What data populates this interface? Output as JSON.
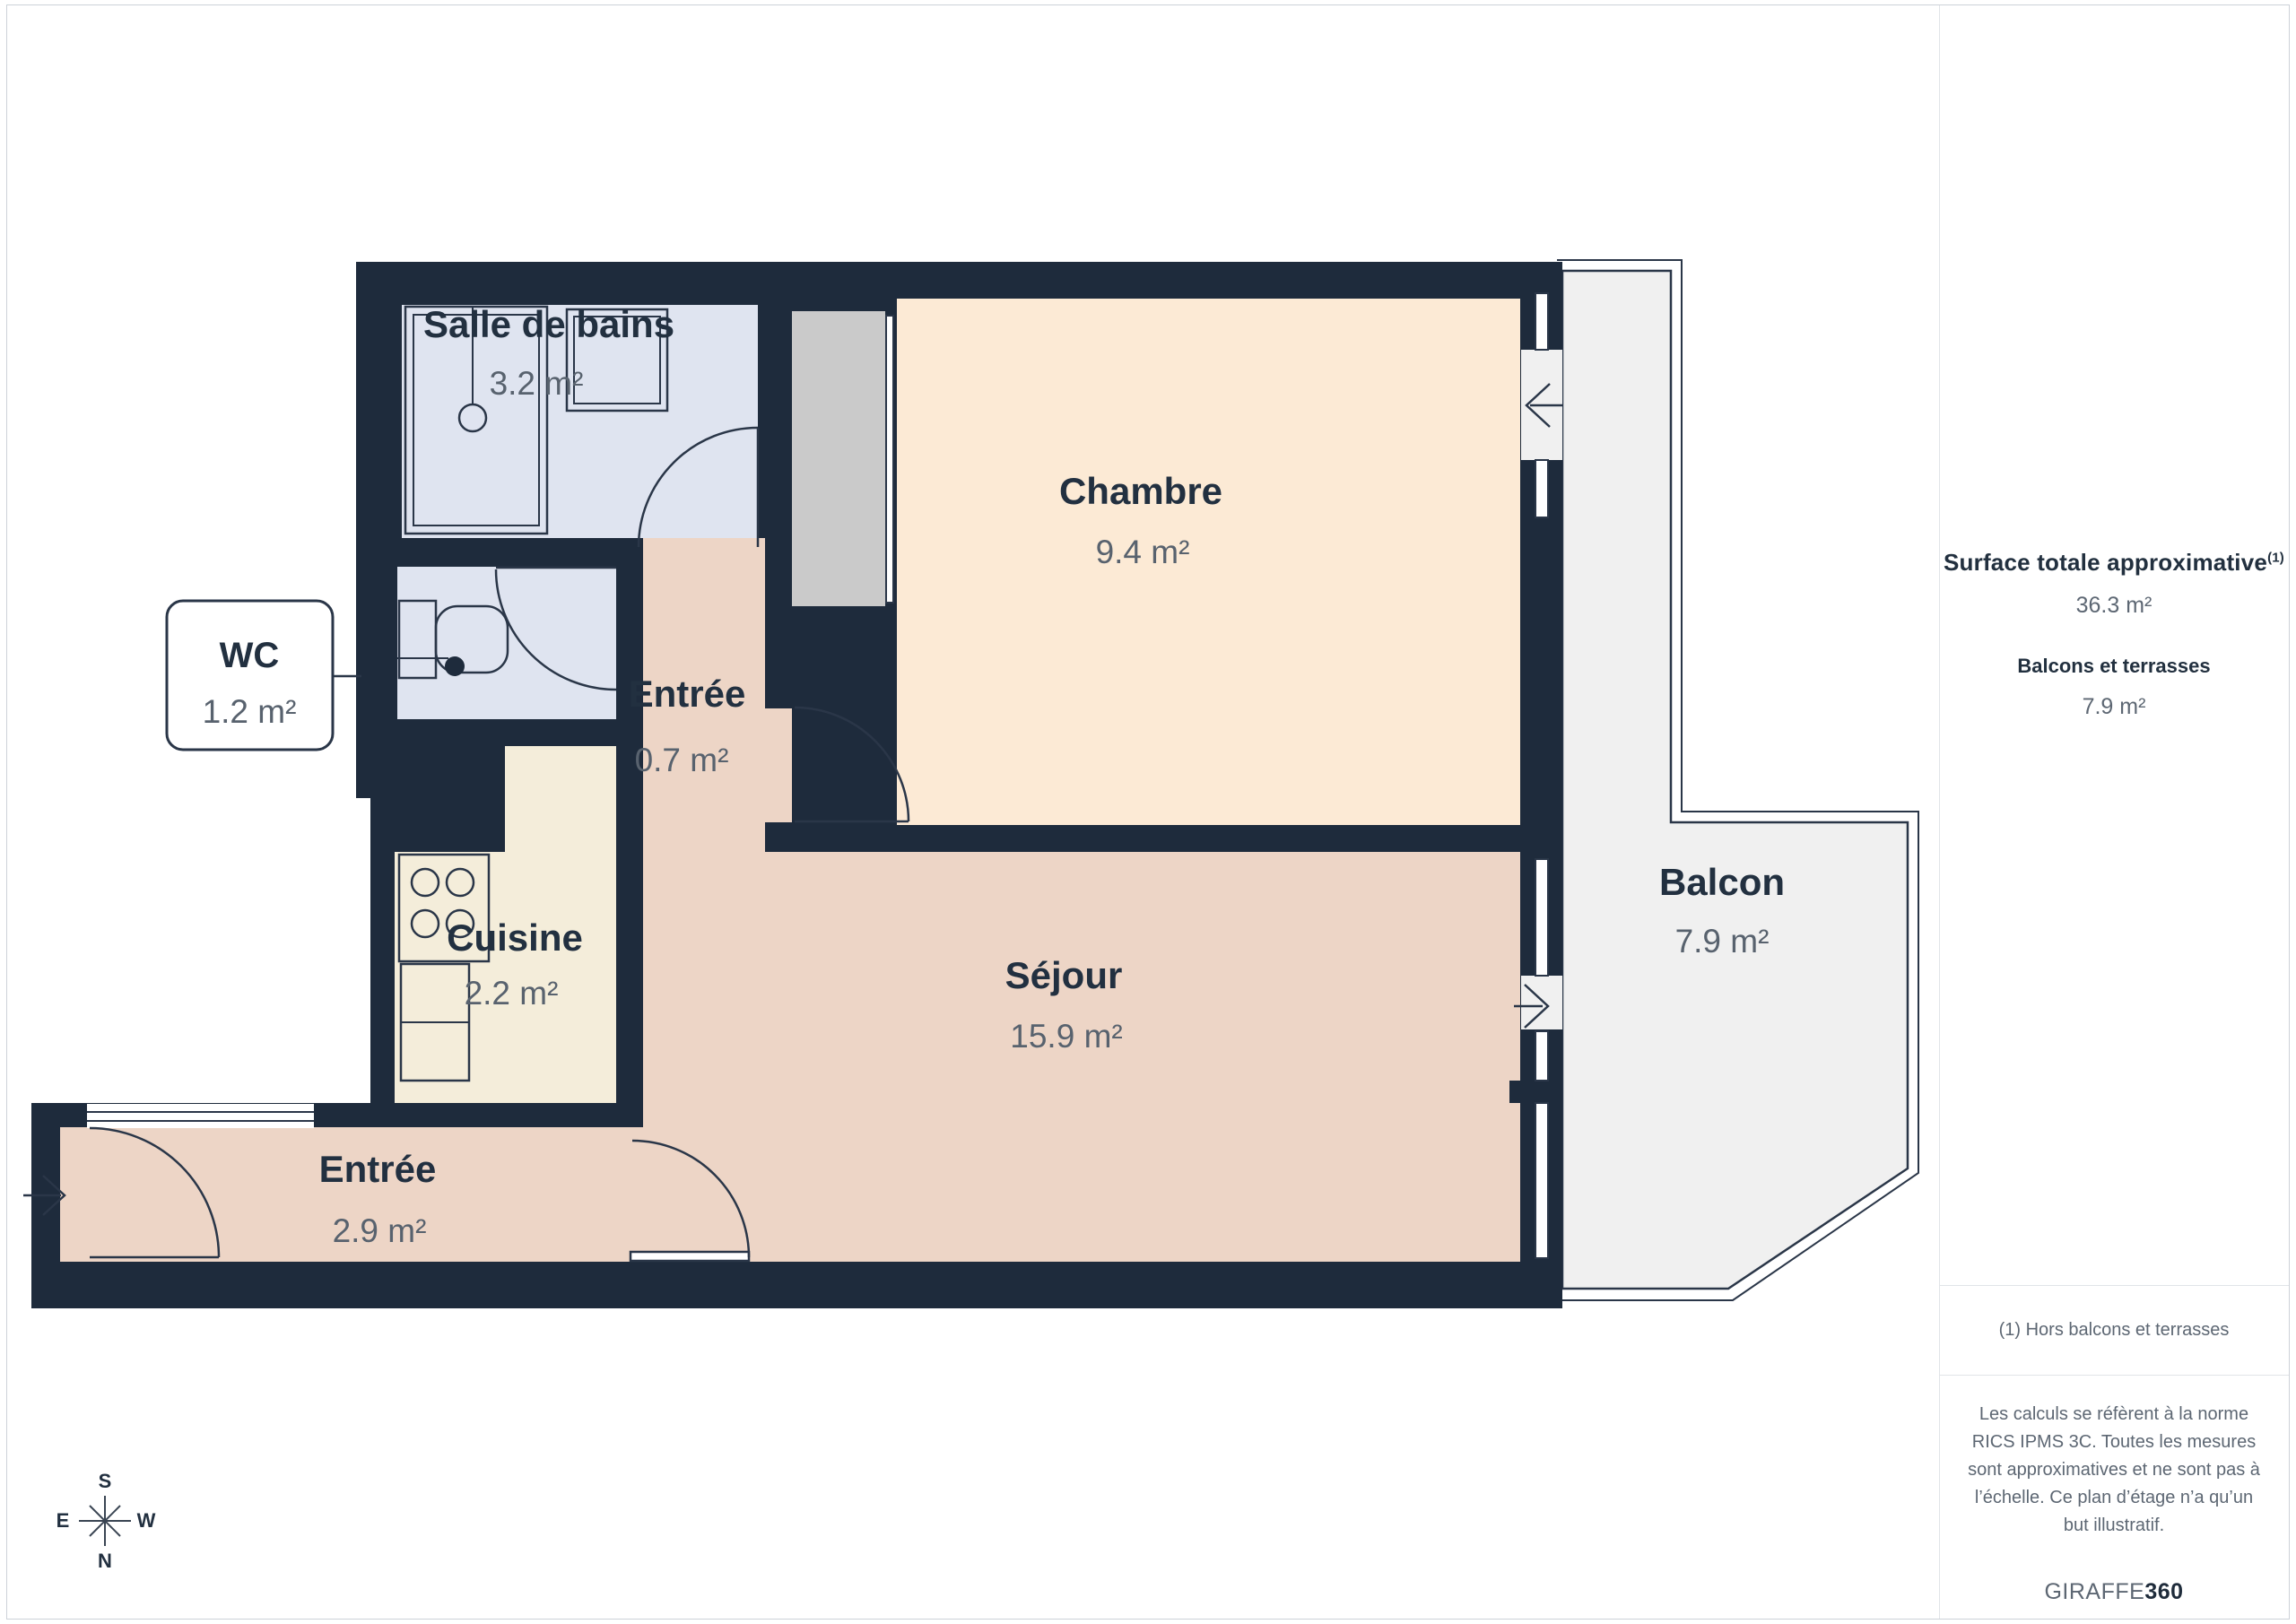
{
  "plan": {
    "rooms": [
      {
        "id": "salle-de-bains",
        "name": "Salle de bains",
        "area": "3.2 m²"
      },
      {
        "id": "chambre",
        "name": "Chambre",
        "area": "9.4 m²"
      },
      {
        "id": "wc",
        "name": "WC",
        "area": "1.2 m²"
      },
      {
        "id": "entree-haut",
        "name": "Entrée",
        "area": "0.7 m²"
      },
      {
        "id": "cuisine",
        "name": "Cuisine",
        "area": "2.2 m²"
      },
      {
        "id": "sejour",
        "name": "Séjour",
        "area": "15.9 m²"
      },
      {
        "id": "entree-bas",
        "name": "Entrée",
        "area": "2.9 m²"
      },
      {
        "id": "balcon",
        "name": "Balcon",
        "area": "7.9 m²"
      }
    ],
    "compass": {
      "n": "N",
      "s": "S",
      "e": "E",
      "w": "W"
    }
  },
  "sidebar": {
    "total_label": "Surface totale approximative",
    "total_sup": "(1)",
    "total_value": "36.3 m²",
    "balconies_label": "Balcons et terrasses",
    "balconies_value": "7.9 m²",
    "footnote": "(1) Hors balcons et terrasses",
    "disclaimer": "Les calculs se réfèrent à la norme RICS IPMS 3C. Toutes les mesures sont approximatives et ne sont pas à l’échelle. Ce plan d’étage n’a qu’un but illustratif.",
    "brand_primary": "GIRAFFE",
    "brand_secondary": "360"
  },
  "colors": {
    "wall": "#1e2b3c",
    "bath": "#dfe4f0",
    "chambre": "#fcead5",
    "sejour": "#edd5c6",
    "cuisine": "#f4edda",
    "closet": "#cacaca",
    "balcony": "#f0f0f0",
    "line": "#2a3648",
    "text_dark": "#223040",
    "text_gray": "#58626e"
  }
}
